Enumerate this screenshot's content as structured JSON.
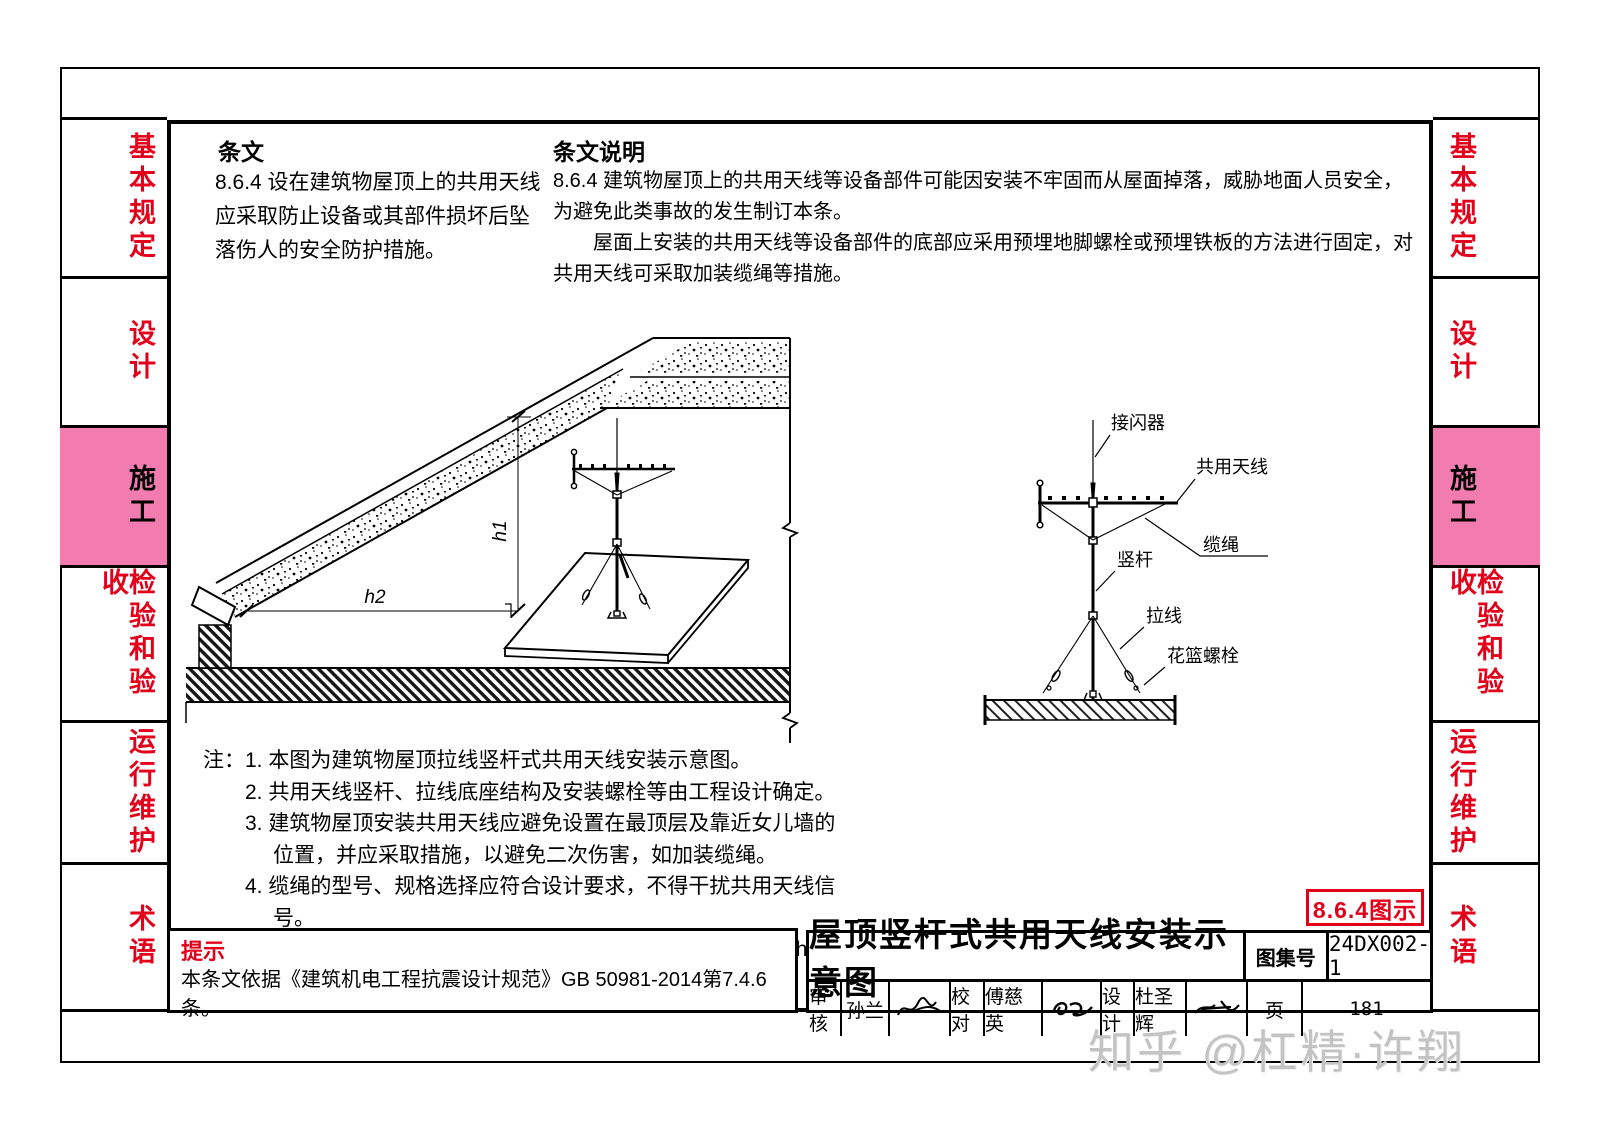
{
  "sidebar": {
    "items": [
      {
        "label": "基本规定",
        "active": false
      },
      {
        "label": "设计",
        "active": false
      },
      {
        "label": "施工",
        "active": true
      },
      {
        "label": "检验和验收",
        "active": false
      },
      {
        "label": "运行维护",
        "active": false
      },
      {
        "label": "术语",
        "active": false
      }
    ]
  },
  "banner": {
    "clause_header": "条文",
    "clause_body": "8.6.4 设在建筑物屋顶上的共用天线应采取防止设备或其部件损坏后坠落伤人的安全防护措施。",
    "explain_header": "条文说明",
    "explain_para1": "8.6.4 建筑物屋顶上的共用天线等设备部件可能因安装不牢固而从屋面掉落，威胁地面人员安全，为避免此类事故的发生制订本条。",
    "explain_para2": "屋面上安装的共用天线等设备部件的底部应采用预埋地脚螺栓或预埋铁板的方法进行固定，对共用天线可采取加装缆绳等措施。"
  },
  "diagram_left": {
    "dim_h1": "h1",
    "dim_h2": "h2"
  },
  "diagram_right": {
    "label_lightning_rod": "接闪器",
    "label_antenna": "共用天线",
    "label_cable": "缆绳",
    "label_mast": "竖杆",
    "label_guy_wire": "拉线",
    "label_turnbuckle": "花篮螺栓"
  },
  "notes": {
    "prefix": "注：",
    "items": [
      "1. 本图为建筑物屋顶拉线竖杆式共用天线安装示意图。",
      "2. 共用天线竖杆、拉线底座结构及安装螺栓等由工程设计确定。",
      "3. 建筑物屋顶安装共用天线应避免设置在最顶层及靠近女儿墙的位置，并应采取措施，以避免二次伤害，如加装缆绳。",
      "4. 缆绳的型号、规格选择应符合设计要求，不得干扰共用天线信号。",
      "5. 共用天线安装位置四周距离女儿墙的距离h2应大于其高度h1。"
    ]
  },
  "tip": {
    "header": "提示",
    "body": "本条文依据《建筑机电工程抗震设计规范》GB 50981-2014第7.4.6条。"
  },
  "titleblock": {
    "title": "屋顶竖杆式共用天线安装示意图",
    "atlas_label": "图集号",
    "atlas_no": "24DX002-1",
    "page_label": "页",
    "page_no": "181",
    "review_label": "审核",
    "review_name": "孙兰",
    "proof_label": "校对",
    "proof_name": "傅慈英",
    "design_label": "设计",
    "design_name": "杜圣辉"
  },
  "code_box": "8.6.4图示",
  "watermark": "知乎 @杠精·许翔",
  "colors": {
    "pink": "#F27BB0",
    "red": "#e2001a",
    "watermark_gray": "#c3c3c3"
  }
}
